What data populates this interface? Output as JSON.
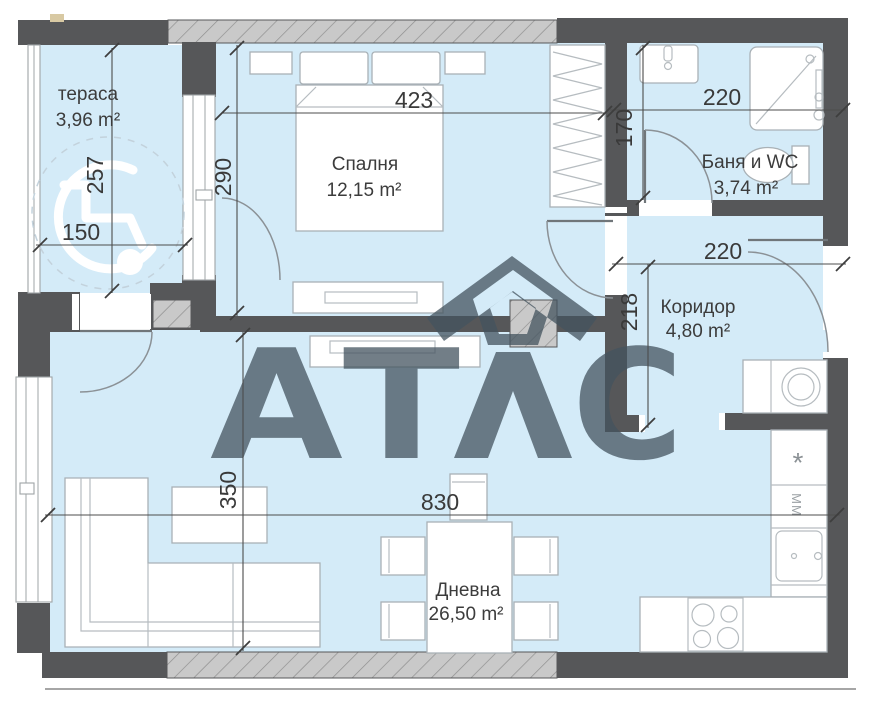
{
  "title": "Apartment floor plan",
  "watermark": {
    "part1": "АТ",
    "part2": "С"
  },
  "rooms": {
    "terrace": {
      "name": "тераса",
      "area": "3,96 m²"
    },
    "bedroom": {
      "name": "Спалня",
      "area": "12,15 m²"
    },
    "bathroom": {
      "name": "Баня и WC",
      "area": "3,74 m²"
    },
    "corridor": {
      "name": "Коридор",
      "area": "4,80 m²"
    },
    "living": {
      "name": "Дневна",
      "area": "26,50 m²"
    }
  },
  "dims": {
    "bedroom_width": "423",
    "bedroom_depth": "290",
    "terrace_depth": "257",
    "terrace_width": "150",
    "bathroom_width": "220",
    "bathroom_depth": "170",
    "corridor_width": "220",
    "corridor_depth": "218",
    "living_width": "830",
    "living_depth": "350"
  },
  "kitchen": {
    "freezer_symbol": "*",
    "microwave_label": "MM"
  },
  "colors": {
    "room_fill": "#d4ebf8",
    "wall": "#565759",
    "watermark": "#44545f",
    "hatch_bg": "#c9c9c9"
  }
}
